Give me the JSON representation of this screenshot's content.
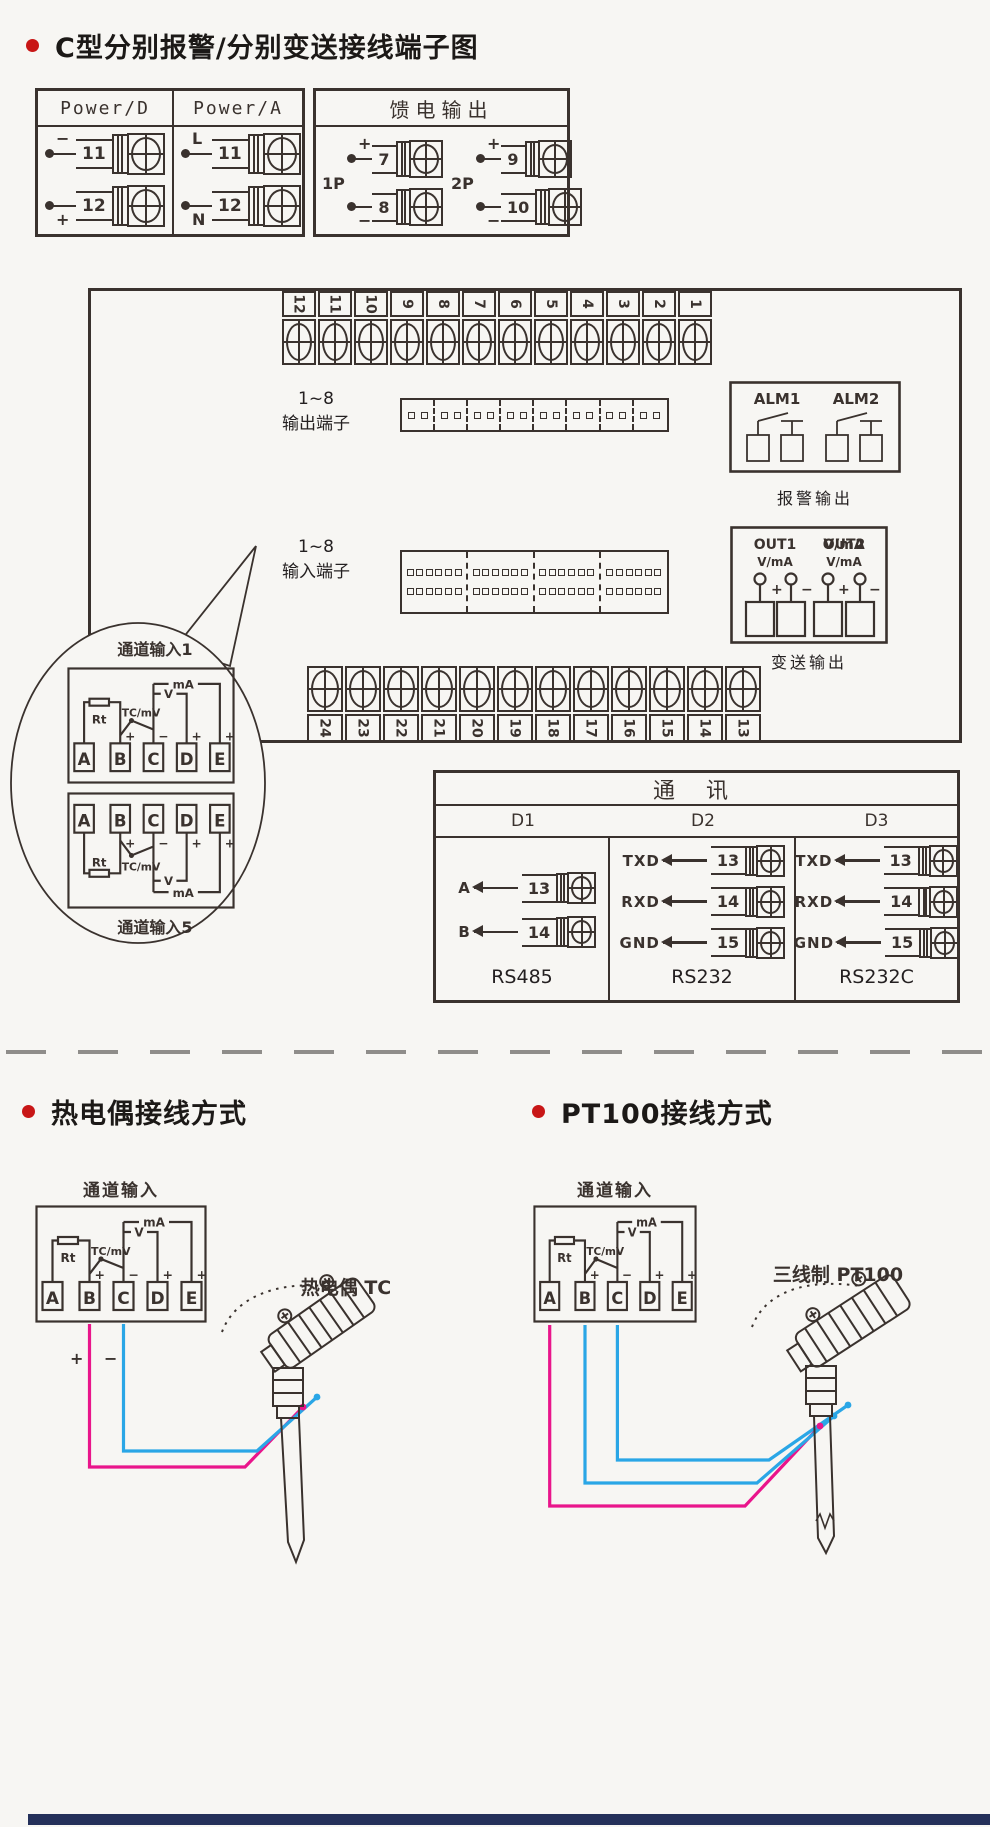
{
  "colors": {
    "background": "#f7f6f3",
    "ink": "#3a322e",
    "accent_red": "#c81616",
    "wire_pink": "#e9158b",
    "wire_blue": "#2aa6e6",
    "footer_bar": "#24305a"
  },
  "title": "C型分别报警/分别变送接线端子图",
  "power_box": {
    "col_d": {
      "header": "Power/D",
      "rows": [
        {
          "sign": "−",
          "num": "11"
        },
        {
          "sign": "+",
          "num": "12"
        }
      ]
    },
    "col_a": {
      "header": "Power/A",
      "rows": [
        {
          "sign": "L",
          "num": "11"
        },
        {
          "sign": "N",
          "num": "12"
        }
      ]
    }
  },
  "feed_box": {
    "header": "馈电输出",
    "groups": [
      {
        "label": "1P",
        "rows": [
          {
            "sign": "+",
            "num": "7"
          },
          {
            "sign": "−",
            "num": "8"
          }
        ]
      },
      {
        "label": "2P",
        "rows": [
          {
            "sign": "+",
            "num": "9"
          },
          {
            "sign": "−",
            "num": "10"
          }
        ]
      }
    ]
  },
  "main_box": {
    "top_strip": [
      "12",
      "11",
      "10",
      "9",
      "8",
      "7",
      "6",
      "5",
      "4",
      "3",
      "2",
      "1"
    ],
    "bottom_strip": [
      "24",
      "23",
      "22",
      "21",
      "20",
      "19",
      "18",
      "17",
      "16",
      "15",
      "14",
      "13"
    ],
    "output": {
      "label_line1": "1~8",
      "label_line2": "输出端子",
      "numbers": [
        "1",
        "2",
        "3",
        "4",
        "5",
        "6",
        "7",
        "8"
      ]
    },
    "input": {
      "label_line1": "1~8",
      "label_line2": "输入端子",
      "numbers_top": [
        "1",
        "2",
        "3",
        "4"
      ],
      "numbers_bottom": [
        "5",
        "6",
        "7",
        "8"
      ]
    },
    "alarm": {
      "label1": "ALM1",
      "label2": "ALM2",
      "caption": "报警输出"
    },
    "transmit": {
      "out1": "OUT1",
      "out2": "OUT2",
      "unit": "V/mA",
      "plus": "+",
      "minus": "−",
      "caption": "变送输出"
    }
  },
  "balloon": {
    "top_label": "通道输入1",
    "bottom_label": "通道输入5"
  },
  "channel": {
    "terminals": [
      "A",
      "B",
      "C",
      "D",
      "E"
    ],
    "rt": "Rt",
    "tc": "TC/mV",
    "v": "V",
    "ma": "mA",
    "sign_b": "+",
    "sign_c": "−",
    "sign_d": "+",
    "sign_e": "+"
  },
  "comm_box": {
    "header": "通  讯",
    "columns": [
      {
        "name": "D1",
        "rows": [
          {
            "label": "A",
            "num": "13"
          },
          {
            "label": "B",
            "num": "14"
          }
        ],
        "caption": "RS485"
      },
      {
        "name": "D2",
        "rows": [
          {
            "label": "TXD",
            "num": "13"
          },
          {
            "label": "RXD",
            "num": "14"
          },
          {
            "label": "GND",
            "num": "15"
          }
        ],
        "caption": "RS232"
      },
      {
        "name": "D3",
        "rows": [
          {
            "label": "TXD",
            "num": "13"
          },
          {
            "label": "RXD",
            "num": "14"
          },
          {
            "label": "GND",
            "num": "15"
          }
        ],
        "caption": "RS232C"
      }
    ]
  },
  "tc_section": {
    "title": "热电偶接线方式",
    "channel_label": "通道输入",
    "probe_label": "热电偶 TC",
    "plus": "+",
    "minus": "−"
  },
  "pt_section": {
    "title": "PT100接线方式",
    "channel_label": "通道输入",
    "probe_label": "三线制 PT100"
  }
}
